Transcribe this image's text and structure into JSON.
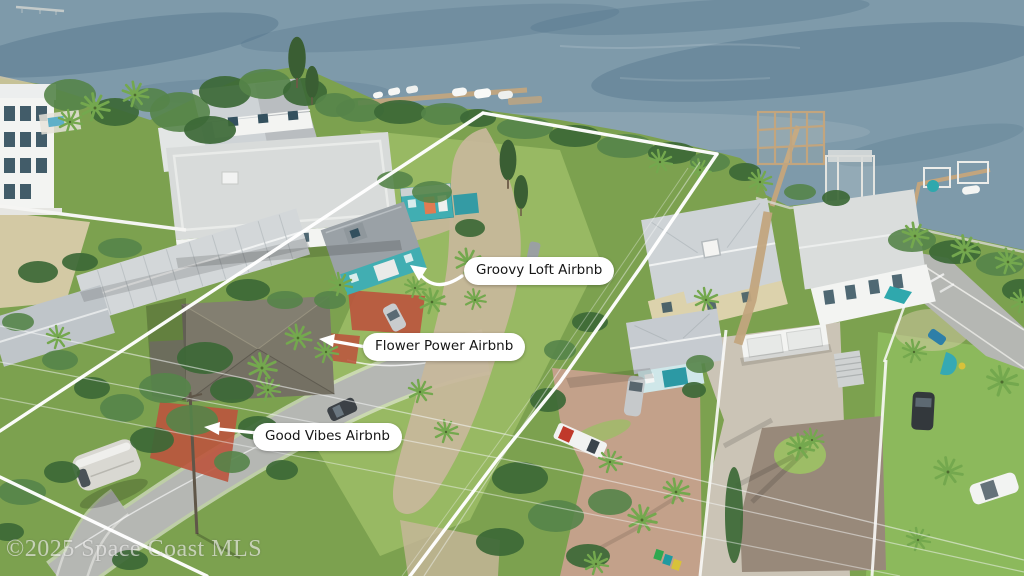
{
  "scene": {
    "type": "aerial-drone-photo",
    "description": "Oblique aerial view of waterfront vacation-rental lots on a river: three labeled Airbnb cottages inside a white surveyed property outline, neighboring houses, docks with boat lifts, roads and palm vegetation"
  },
  "annotations": {
    "labels": {
      "groovy": {
        "text": "Groovy Loft Airbnb"
      },
      "flower": {
        "text": "Flower Power Airbnb"
      },
      "good": {
        "text": "Good Vibes Airbnb"
      }
    },
    "boundary_color": "#ffffff"
  },
  "watermark": {
    "text": "©2025 Space Coast MLS"
  },
  "colors": {
    "water-deep": "#64869b",
    "water-mid": "#7e9aaa",
    "water-light": "#9ab0ba",
    "water-dark": "#54758c",
    "sand": "#d8cba9",
    "grass": "#7ca14f",
    "grass-light": "#9dbd66",
    "lawn": "#8cb95c",
    "tree-dark": "#3c6836",
    "tree-mid": "#558449",
    "palm": "#74a84e",
    "road": "#b5b7b3",
    "curb": "#f4f4f0",
    "dirt": "#c8b79b",
    "gravel": "#98897a",
    "paver": "#cbc4b6",
    "brick": "#c7a18d",
    "red-pave": "#bb543d",
    "roof-gray": "#c6cbd0",
    "roof-light": "#dadddc",
    "roof-dark": "#7b7769",
    "metal": "#ced3d6",
    "wall-white": "#f3f4f2",
    "window-dark": "#33505e",
    "cream": "#dcd2ac",
    "aqua": "#cfe7e9",
    "teal": "#41aeb2",
    "teal-deep": "#2c99a4",
    "coral": "#e07b52",
    "wood": "#c2a57e",
    "boundary": "#ffffff",
    "wire": "#f5f7f7",
    "label-bg": "#ffffff",
    "label-text": "#161616",
    "watermark": "#e9e9e7"
  }
}
